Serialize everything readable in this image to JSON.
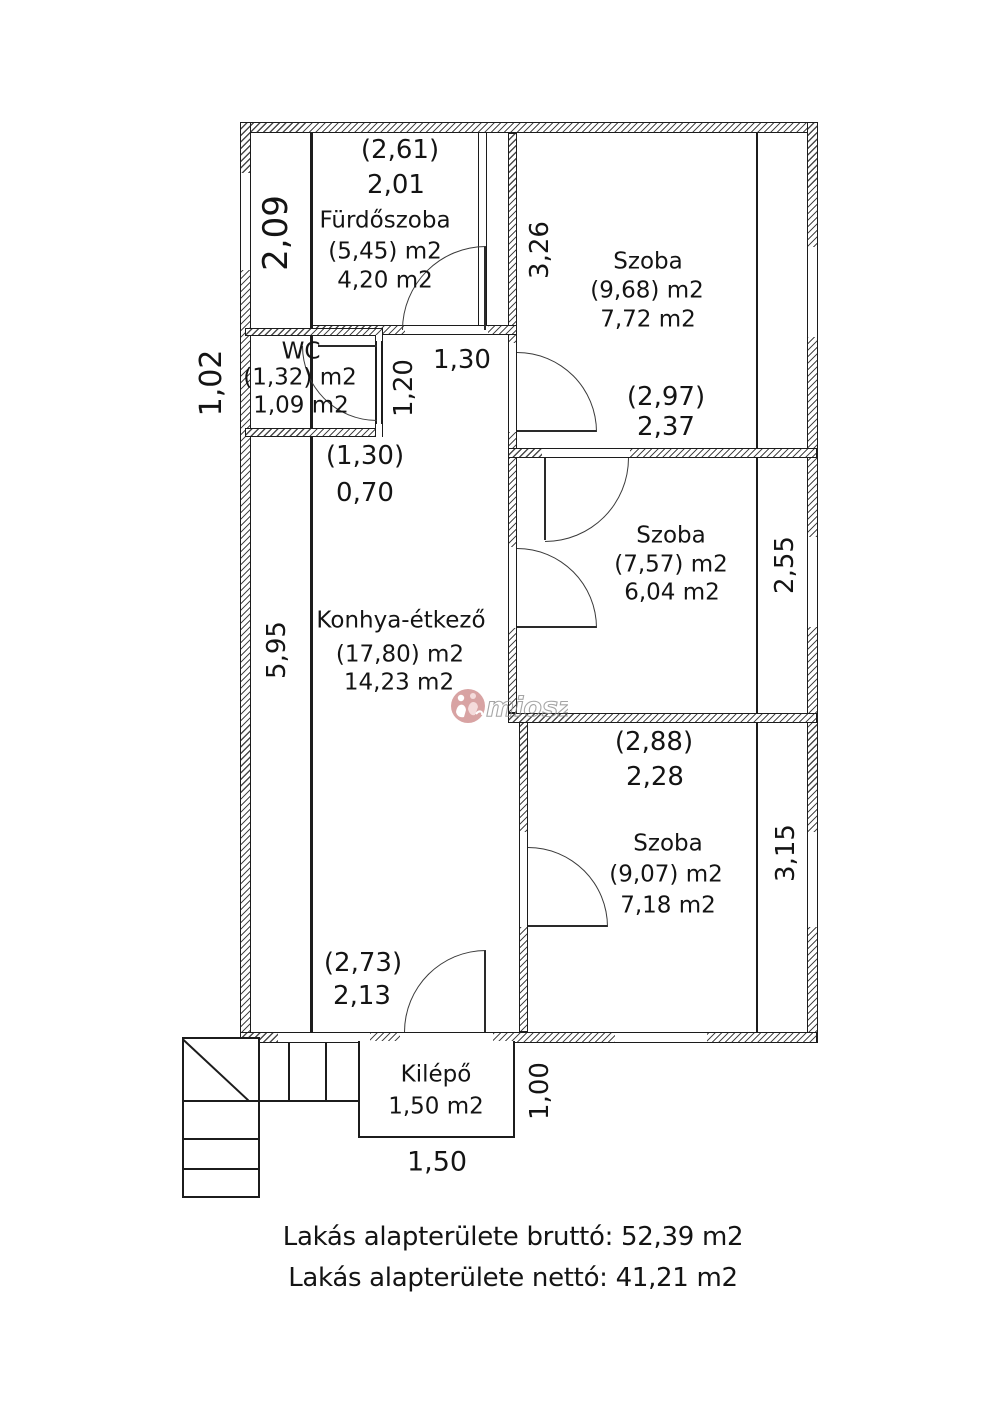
{
  "plan_title": "floor plan",
  "rooms": {
    "bathroom": {
      "dim_top_gross": "(2,61)",
      "dim_top_net": "2,01",
      "name": "Fürdőszoba",
      "area_gross": "(5,45) m2",
      "area_net": "4,20 m2"
    },
    "wc": {
      "name": "WC",
      "area_gross": "(1,32) m2",
      "area_net": "1,09 m2"
    },
    "hall": {
      "area_gross": "(1,30)",
      "area_net": "0,70"
    },
    "kitchen": {
      "name": "Konhya-étkező",
      "area_gross": "(17,80) m2",
      "area_net": "14,23 m2",
      "dim_bottom_gross": "(2,73)",
      "dim_bottom_net": "2,13"
    },
    "room_top": {
      "name": "Szoba",
      "area_gross": "(9,68) m2",
      "area_net": "7,72 m2",
      "dim_bottom_gross": "(2,97)",
      "dim_bottom_net": "2,37"
    },
    "room_middle": {
      "name": "Szoba",
      "area_gross": "(7,57) m2",
      "area_net": "6,04 m2"
    },
    "room_bottom": {
      "dim_top_gross": "(2,88)",
      "dim_top_net": "2,28",
      "name": "Szoba",
      "area_gross": "(9,07) m2",
      "area_net": "7,18 m2"
    },
    "kilepo": {
      "name": "Kilépő",
      "area": "1,50 m2"
    }
  },
  "dimensions": {
    "left_top": "2,09",
    "left_upper": "1,02",
    "left_lower": "5,95",
    "room_top_h": "3,26",
    "hall_w": "1,30",
    "hall_h": "1,20",
    "room_middle_h": "2,55",
    "room_bottom_h": "3,15",
    "kilepo_w": "1,50",
    "kilepo_h": "1,00"
  },
  "summary": {
    "line1": "Lakás alapterülete bruttó: 52,39 m2",
    "line2": "Lakás alapterülete nettó: 41,21 m2"
  },
  "watermark": {
    "text": "miosz"
  },
  "colors": {
    "line": "#1c1c1c",
    "hatch": "#4a4a4a",
    "watermark_pink": "#cf8d8d",
    "watermark_gray": "#8f8f8f"
  }
}
